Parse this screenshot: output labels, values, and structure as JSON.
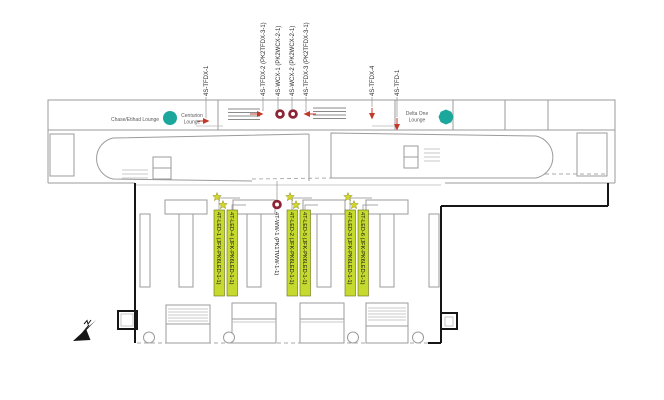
{
  "colors": {
    "highlight": "#c6d92f",
    "star": "#d6d829",
    "arrow_red": "#c0392b",
    "donut_red": "#8c2433",
    "lounge_teal": "#1ba79b",
    "wall_gray": "#9b9b9b",
    "envelope_black": "#161616"
  },
  "lounges": {
    "chase_etihad": "Chase/Etihad Lounge",
    "centurion": [
      "Centurion",
      "Lounge"
    ],
    "delta_one": [
      "Delta One",
      "Lounge"
    ]
  },
  "top_labels": [
    "4S-TFDX-1",
    "4S-TFDX-2 (PK2TFDX-3-1)",
    "4S-WCX-1 (PK2WCX-2-1)",
    "4S-WCX-2 (PK2WCX-2-1)",
    "4S-TFDX-3 (PK2TFDX-3-1)",
    "4S-TFDX-4",
    "4S-TFD-1"
  ],
  "mid_labels": {
    "white": "4T-WW-1 (PK1TWW-1-1)",
    "highlighted": [
      "4T-LED-1 (JFK-PK6LED-1-1)",
      "4T-LED-4 (JFK-PK6LED-1-1)",
      "4T-LED-2 (JFK-PK6LED-1-1)",
      "4T-LED-5 (JFK-PK6LED-1-1)",
      "4T-LED-3 (JFK-PK6LED-1-1)",
      "4T-LED-6 (JFK-PK6LED-1-1)"
    ]
  }
}
